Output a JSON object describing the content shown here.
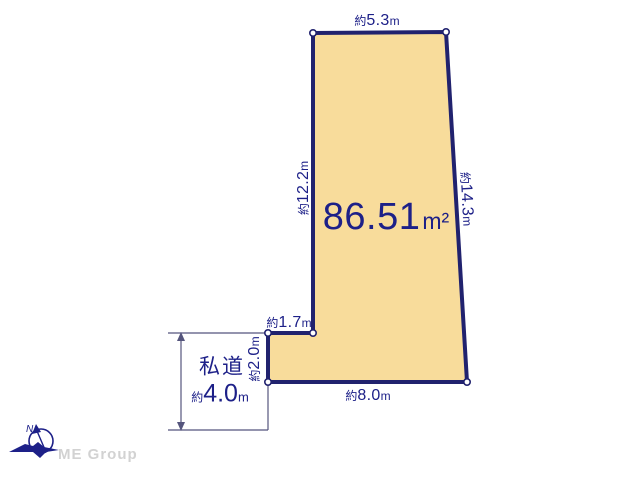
{
  "diagram": {
    "area_label": {
      "value": "86.51",
      "unit": "m²"
    },
    "dimensions": {
      "top": {
        "prefix": "約",
        "value": "5.3",
        "unit": "m"
      },
      "left": {
        "prefix": "約",
        "value": "12.2",
        "unit": "m"
      },
      "right": {
        "prefix": "約",
        "value": "14.3",
        "unit": "m"
      },
      "setback_width": {
        "prefix": "約",
        "value": "1.7",
        "unit": "m"
      },
      "setback_depth": {
        "prefix": "約",
        "value": "2.0",
        "unit": "m"
      },
      "bottom": {
        "prefix": "約",
        "value": "8.0",
        "unit": "m"
      }
    },
    "private_road": {
      "name": "私道",
      "prefix": "約",
      "value": "4.0",
      "unit": "m"
    },
    "colors": {
      "plot_fill": "#F8DC9B",
      "outline": "#21226E",
      "text": "#1D2088",
      "thin_line": "#55557D",
      "brand_gray": "#D2D2D2"
    }
  },
  "compass": {
    "letter": "N"
  },
  "footer": {
    "brand": "ME Group"
  }
}
